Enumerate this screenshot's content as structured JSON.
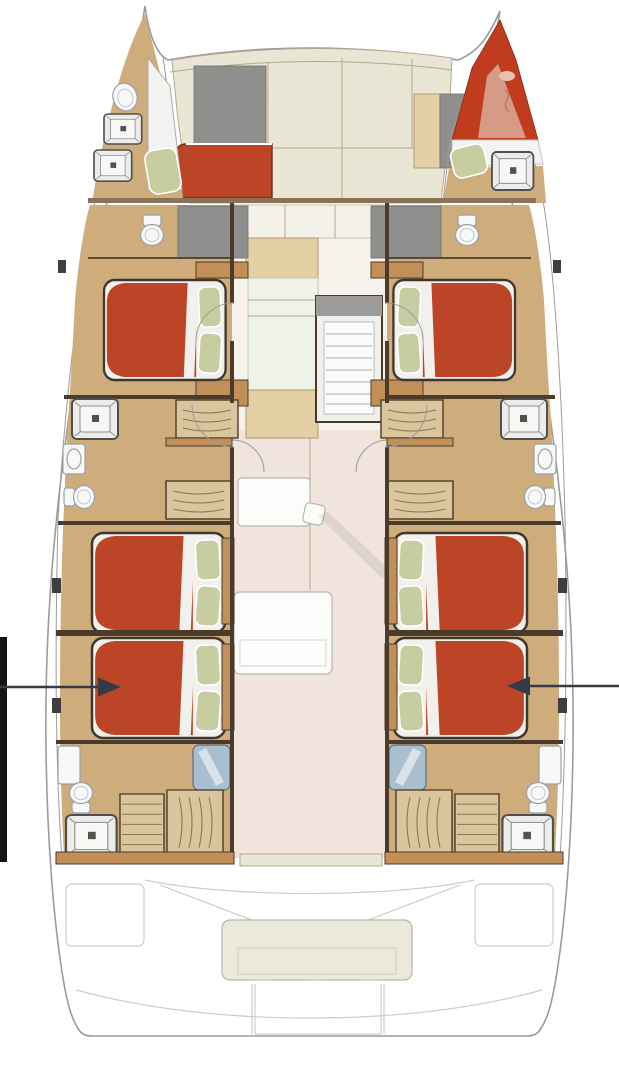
{
  "meta": {
    "diagram": "catamaran-interior-deck-plan",
    "orientation": "bow-up",
    "style": "rendered-floorplan-no-text"
  },
  "colors": {
    "hull_line": "#9b9b99",
    "deck_cream": "#eae6d6",
    "deck_seam": "#b7a88c",
    "window_gray": "#8f8f8d",
    "wood_floor": "#cfac7c",
    "wood_light": "#e5cfa5",
    "wood_mid": "#c38f58",
    "wall": "#4b3b2b",
    "wall_band": "#8a7354",
    "bed_red": "#bd4527",
    "bed_outline": "#3f362c",
    "mattress": "#f1f0ec",
    "pillow": "#c8cda1",
    "skipper_red": "#c13c1e",
    "skipper_pink": "#d69b86",
    "fixture_fill": "#f7f8f8",
    "fixture_line": "#9aa0a3",
    "shower": "#a9bfd0",
    "salon_floor": "#f0e4dd",
    "salon_floor_top": "#f6f1ea",
    "galley_white": "#eff3e7",
    "stair_wood": "#dbc59c",
    "tread": "#8a7657",
    "table_white": "#fcfcfb",
    "cockpit_line": "#cdcdc7",
    "cockpit_bench": "#ebe9da",
    "arrow": "#343a46",
    "black_bar": "#141414"
  },
  "vessel": {
    "type": "catamaran",
    "hulls": [
      "port",
      "starboard"
    ],
    "cabins": [
      {
        "id": "port-bow-compartment",
        "items": [
          "deck-hatch",
          "deck-hatch",
          "toilet",
          "seat-cushion"
        ]
      },
      {
        "id": "starboard-bow-skipper-cabin",
        "items": [
          "v-berth-red",
          "pillow",
          "deck-hatch"
        ]
      },
      {
        "id": "port-forward-cabin",
        "items": [
          "double-berth-red",
          "pillows-2",
          "shower",
          "toilet"
        ]
      },
      {
        "id": "starboard-forward-cabin",
        "items": [
          "double-berth-red",
          "pillows-2",
          "shower",
          "toilet"
        ]
      },
      {
        "id": "port-midship-head",
        "items": [
          "deck-hatch",
          "sink",
          "toilet",
          "drawer-steps",
          "drawer-steps"
        ]
      },
      {
        "id": "starboard-midship-head",
        "items": [
          "deck-hatch",
          "sink",
          "toilet",
          "drawer-steps",
          "drawer-steps"
        ]
      },
      {
        "id": "port-aft-cabin-forward",
        "items": [
          "double-berth-red",
          "pillows-2"
        ]
      },
      {
        "id": "port-aft-cabin-aft",
        "items": [
          "double-berth-red",
          "pillows-2"
        ]
      },
      {
        "id": "starboard-aft-cabin-forward",
        "items": [
          "double-berth-red",
          "pillows-2"
        ]
      },
      {
        "id": "starboard-aft-cabin-aft",
        "items": [
          "double-berth-red",
          "pillows-2"
        ]
      },
      {
        "id": "port-aft-head",
        "items": [
          "toilet",
          "shower",
          "stairs",
          "deck-hatch"
        ]
      },
      {
        "id": "starboard-aft-head",
        "items": [
          "toilet",
          "shower",
          "stairs",
          "deck-hatch"
        ]
      }
    ],
    "common_areas": [
      "foredeck",
      "forward-cockpit-seat",
      "salon",
      "galley",
      "entry-steps",
      "nav-desk",
      "salon-table",
      "aft-cockpit",
      "aft-bench"
    ]
  },
  "annotations": {
    "left_callout": {
      "shape": "arrow",
      "direction": "right",
      "y": 687,
      "target": "port-aft-cabin-aft-berth"
    },
    "right_callout": {
      "shape": "arrow",
      "direction": "left",
      "y": 686,
      "target": "starboard-aft-cabin-aft-berth"
    },
    "left_edge_bar": {
      "shape": "black-rectangle",
      "x": 0,
      "y": 637,
      "w": 7,
      "h": 225
    }
  }
}
